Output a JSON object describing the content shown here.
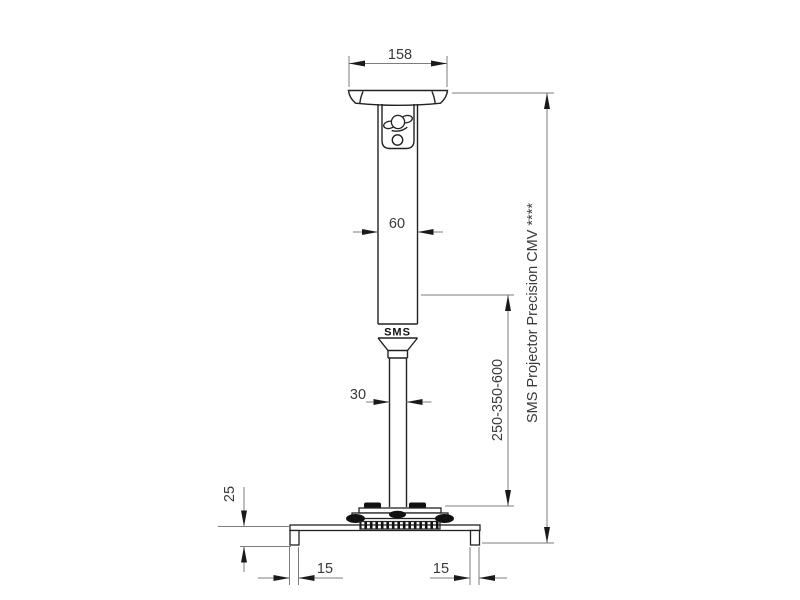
{
  "drawing": {
    "product_label": "SMS Projector Precision CMV ****",
    "logo_text": "SMS",
    "dims": {
      "plate_width": "158",
      "column_width": "60",
      "tube_width": "30",
      "height_range": "250-350-600",
      "bracket_drop": "25",
      "left_foot": "15",
      "right_foot": "15"
    },
    "colors": {
      "object_line": "#222222",
      "dimension_line": "#7d7d7d",
      "arrowhead": "#1a1a1a",
      "text": "#3a3a3a",
      "logo": "#111111",
      "background": "#ffffff"
    }
  }
}
